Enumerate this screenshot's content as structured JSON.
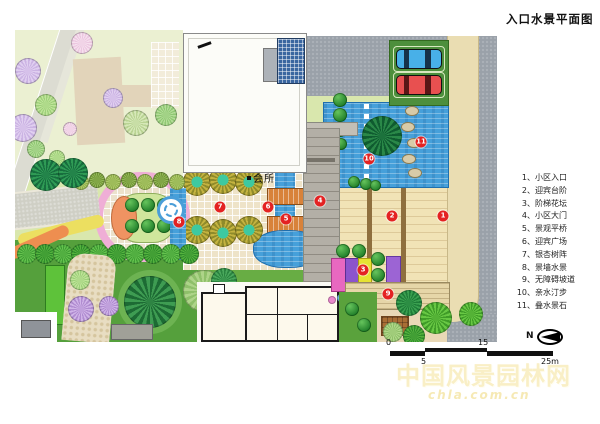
{
  "title": "入口水景平面图",
  "plan": {
    "building_label": "会所"
  },
  "legend": {
    "separator": "、",
    "items": [
      {
        "num": "1",
        "label": "小区入口"
      },
      {
        "num": "2",
        "label": "迎宾台阶"
      },
      {
        "num": "3",
        "label": "阶梯花坛"
      },
      {
        "num": "4",
        "label": "小区大门"
      },
      {
        "num": "5",
        "label": "景观平桥"
      },
      {
        "num": "6",
        "label": "迎宾广场"
      },
      {
        "num": "7",
        "label": "银杏树阵"
      },
      {
        "num": "8",
        "label": "景墙水景"
      },
      {
        "num": "9",
        "label": "无障碍坡道"
      },
      {
        "num": "10",
        "label": "亲水汀步"
      },
      {
        "num": "11",
        "label": "叠水景石"
      }
    ]
  },
  "scale_bar": {
    "labels": [
      "0",
      "5",
      "15",
      "25m"
    ]
  },
  "north": {
    "label": "N"
  },
  "watermark": {
    "line1": "中国风景园林网",
    "line2": "chla.com.cn"
  },
  "colors": {
    "marker_red": "#e42222",
    "water_blue": "#46a0da",
    "road_gray": "#9aa1a9",
    "paving_beige": "#f1e3b6",
    "oval_pink": "#efaed6",
    "bridge_orange": "#d8823a",
    "lawn_green": "#55a03c",
    "parking_green": "#4d8f3c",
    "sidewalk_tan": "#eaddb2"
  }
}
